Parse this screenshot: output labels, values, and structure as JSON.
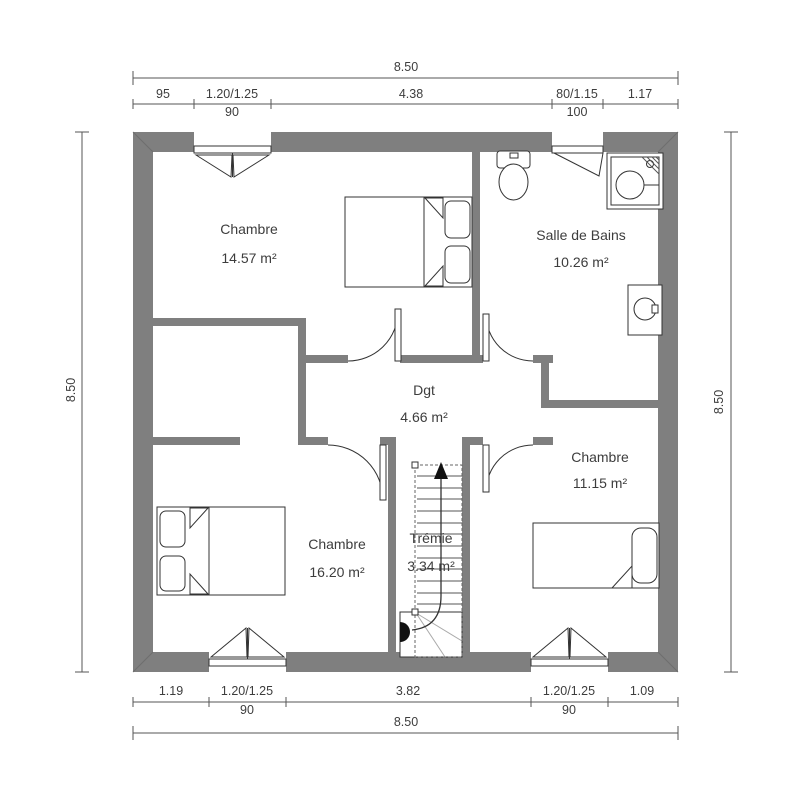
{
  "rooms": [
    {
      "name": "Chambre",
      "area": "14.57 m²"
    },
    {
      "name": "Salle de Bains",
      "area": "10.26 m²"
    },
    {
      "name": "Dgt",
      "area": "4.66 m²"
    },
    {
      "name": "Chambre",
      "area": "11.15 m²"
    },
    {
      "name": "Chambre",
      "area": "16.20 m²"
    },
    {
      "name": "Trémie",
      "area": "3.34 m²"
    }
  ],
  "dimensions": {
    "top": {
      "overall": "8.50",
      "segments": [
        "95",
        "1.20/1.25",
        "4.38",
        "80/1.15",
        "1.17"
      ],
      "window_sills": [
        "90",
        "100"
      ]
    },
    "bottom": {
      "overall": "8.50",
      "segments": [
        "1.19",
        "1.20/1.25",
        "3.82",
        "1.20/1.25",
        "1.09"
      ],
      "window_sills": [
        "90",
        "90"
      ]
    },
    "left": {
      "overall": "8.50"
    },
    "right": {
      "overall": "8.50"
    }
  },
  "colors": {
    "wall": "#7f7f7f",
    "line": "#333333",
    "text": "#3d3d3d",
    "background": "#ffffff"
  }
}
